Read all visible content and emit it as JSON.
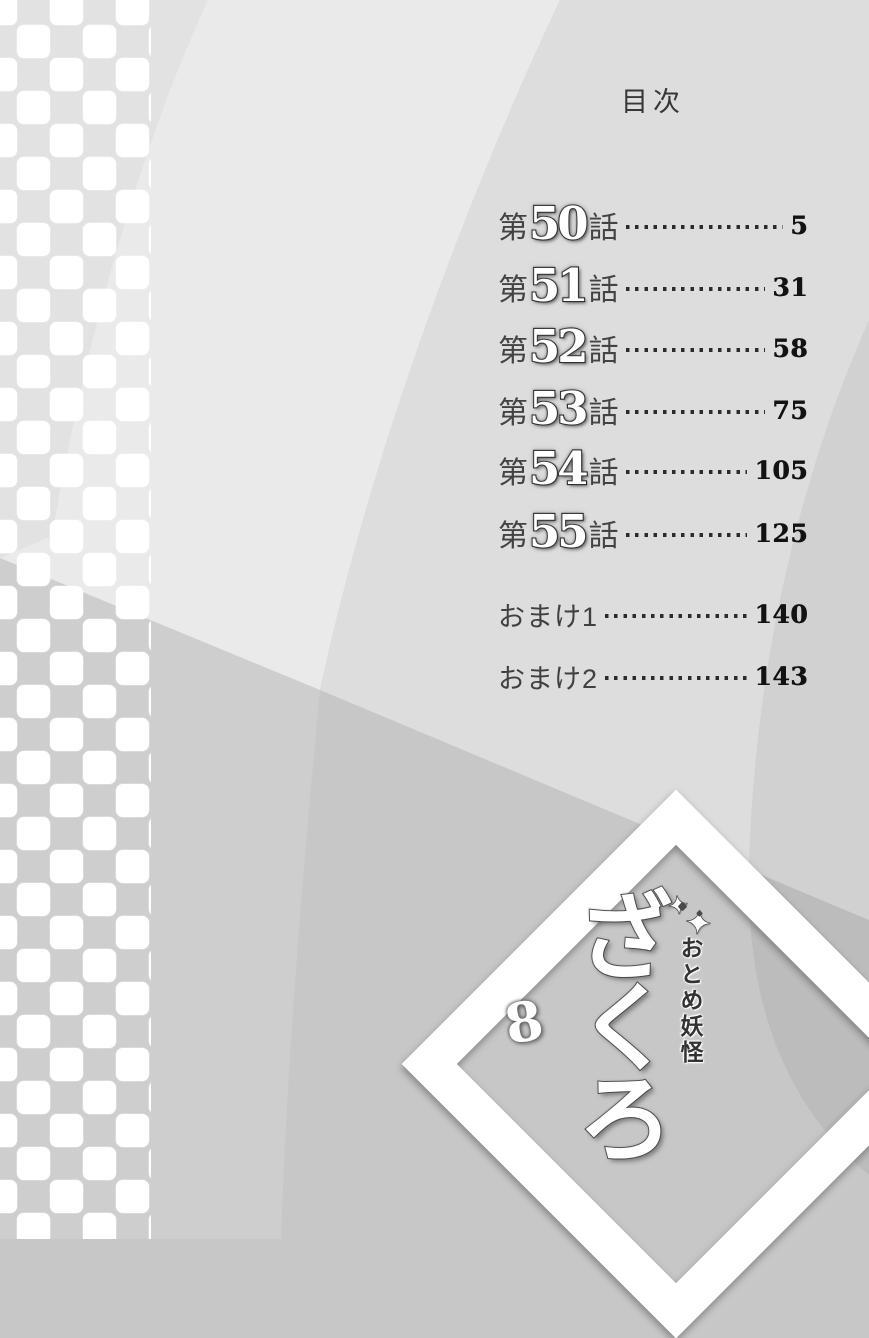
{
  "page": {
    "title": "目次"
  },
  "toc": {
    "chapters": [
      {
        "prefix": "第",
        "number": "50",
        "suffix": "話",
        "page": "5"
      },
      {
        "prefix": "第",
        "number": "51",
        "suffix": "話",
        "page": "31"
      },
      {
        "prefix": "第",
        "number": "52",
        "suffix": "話",
        "page": "58"
      },
      {
        "prefix": "第",
        "number": "53",
        "suffix": "話",
        "page": "75"
      },
      {
        "prefix": "第",
        "number": "54",
        "suffix": "話",
        "page": "105"
      },
      {
        "prefix": "第",
        "number": "55",
        "suffix": "話",
        "page": "125"
      }
    ],
    "extras": [
      {
        "label": "おまけ1",
        "page": "140"
      },
      {
        "label": "おまけ2",
        "page": "143"
      }
    ]
  },
  "logo": {
    "series_label": "おとめ妖怪",
    "title": "ざくろ",
    "volume": "8",
    "sparkle": "✦"
  },
  "colors": {
    "paper_light": "#eaeaea",
    "paper_mid": "#dddddd",
    "paper_dark": "#c7c7c7",
    "lower_left": "#cecece",
    "text_dark": "#434343",
    "page_number": "#121212",
    "white": "#ffffff"
  }
}
